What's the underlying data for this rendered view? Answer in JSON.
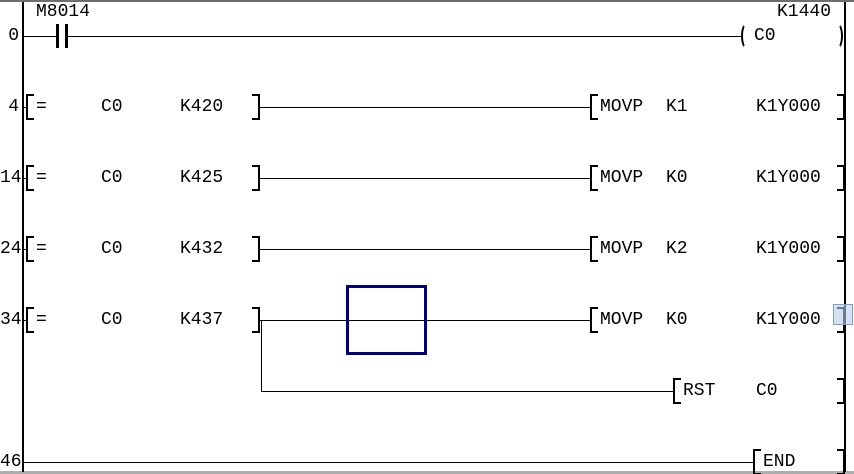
{
  "editor": {
    "background": "#ffffff",
    "wire_color": "#000000",
    "cursor_border_color": "#000080",
    "highlight_fill": "#b7cfec",
    "highlight_border": "#7aa0cc"
  },
  "rungs": [
    {
      "step": "0",
      "contact": {
        "label": "M8014"
      },
      "coil": {
        "device": "C0",
        "preset": "K1440"
      }
    },
    {
      "step": "4",
      "compare": {
        "op": "=",
        "left": "C0",
        "right": "K420"
      },
      "out": {
        "mnemonic": "MOVP",
        "source": "K1",
        "dest": "K1Y000"
      }
    },
    {
      "step": "14",
      "compare": {
        "op": "=",
        "left": "C0",
        "right": "K425"
      },
      "out": {
        "mnemonic": "MOVP",
        "source": "K0",
        "dest": "K1Y000"
      }
    },
    {
      "step": "24",
      "compare": {
        "op": "=",
        "left": "C0",
        "right": "K432"
      },
      "out": {
        "mnemonic": "MOVP",
        "source": "K2",
        "dest": "K1Y000"
      }
    },
    {
      "step": "34",
      "compare": {
        "op": "=",
        "left": "C0",
        "right": "K437"
      },
      "out": {
        "mnemonic": "MOVP",
        "source": "K0",
        "dest": "K1Y000"
      },
      "branch": {
        "mnemonic": "RST",
        "operand": "C0"
      }
    },
    {
      "step": "46",
      "end": {
        "mnemonic": "END"
      }
    }
  ]
}
